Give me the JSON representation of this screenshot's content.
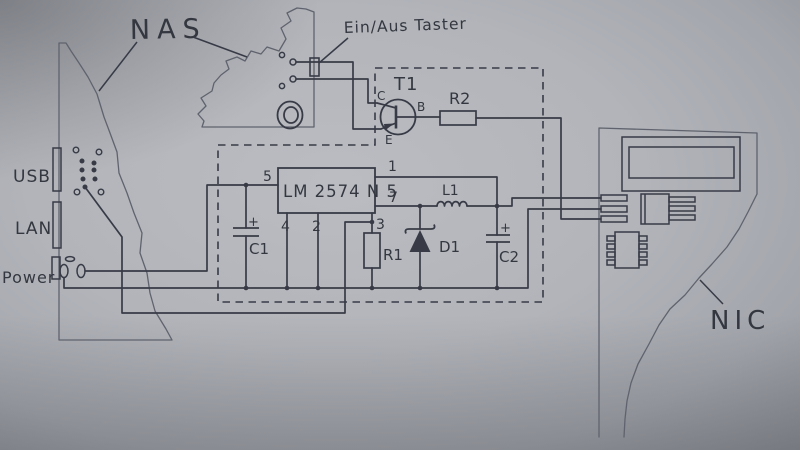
{
  "colors": {
    "paper": "#b4b6bc",
    "paper_edge": "#8c8e95",
    "ink": "#383b46",
    "ink_light": "#60636d"
  },
  "labels": {
    "nas": "NAS",
    "power_button": "Ein/Aus Taster",
    "nic": "NIC",
    "usb": "USB",
    "lan": "LAN",
    "power": "Power"
  },
  "regulator": {
    "name": "LM 2574 N 5",
    "pins": {
      "p5": "5",
      "p1": "1",
      "p7": "7",
      "p4": "4",
      "p2": "2",
      "p3": "3"
    }
  },
  "transistor": {
    "ref": "T1",
    "collector": "C",
    "base": "B",
    "emitter": "E"
  },
  "parts": {
    "r1": "R1",
    "r2": "R2",
    "c1": "C1",
    "c2": "C2",
    "d1": "D1",
    "l1": "L1"
  },
  "symbols": {
    "plus": "+"
  }
}
